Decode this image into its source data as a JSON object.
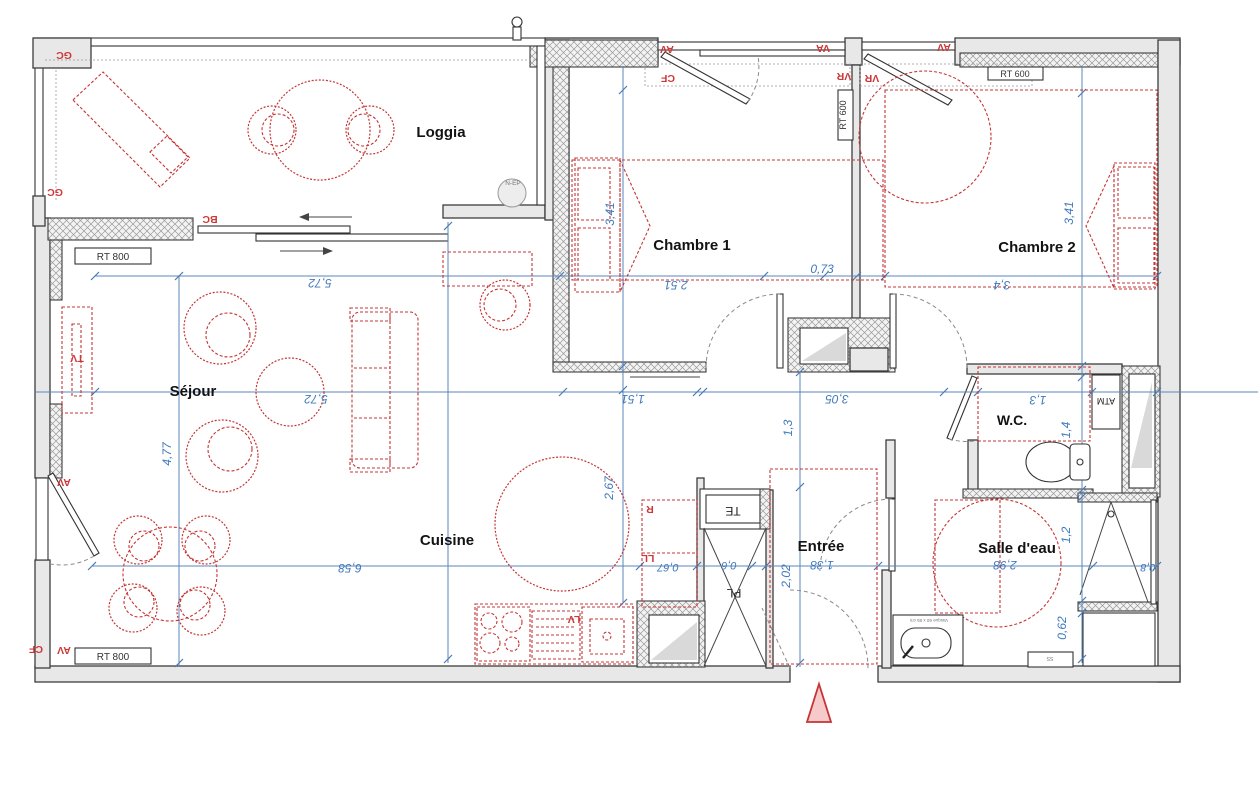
{
  "rooms": {
    "loggia": "Loggia",
    "chambre1": "Chambre 1",
    "chambre2": "Chambre 2",
    "sejour": "Séjour",
    "cuisine": "Cuisine",
    "entree": "Entrée",
    "wc": "W.C.",
    "salle_eau": "Salle d'eau"
  },
  "dims": {
    "sejour_w_top": "5,72",
    "sejour_w_mid": "5,72",
    "sejour_h": "4,77",
    "cuisine_w": "6,58",
    "ch1_h": "3,41",
    "ch1_w": "2,51",
    "top_073": "0,73",
    "ch2_w": "3,4",
    "ch2_h": "3,41",
    "hall_151": "1,51",
    "hall_305": "3,05",
    "hall_13": "1,3",
    "wc_w": "1,3",
    "wc_h": "1,4",
    "cuisine_267": "2,67",
    "fridge_067": "0,67",
    "pl_06": "0,6",
    "entree_h": "2,02",
    "entree_w": "1,38",
    "sdb_w": "2,98",
    "sdb_12": "1,2",
    "shower_08": "0,8",
    "sdb_062": "0,62"
  },
  "tags": {
    "gc": "GC",
    "bc": "BC",
    "av": "AV",
    "va": "VA",
    "cf": "CF",
    "vr": "VR",
    "rt600": "RT 600",
    "rt800": "RT 800",
    "tv": "TV",
    "fridge": "R",
    "ll": "LL",
    "lv": "LV",
    "te": "TE",
    "pl": "PL",
    "atm": "ATM",
    "nep": "N-EP",
    "ss": "SS",
    "vasque": "Vasque 60 x 55 cm"
  }
}
